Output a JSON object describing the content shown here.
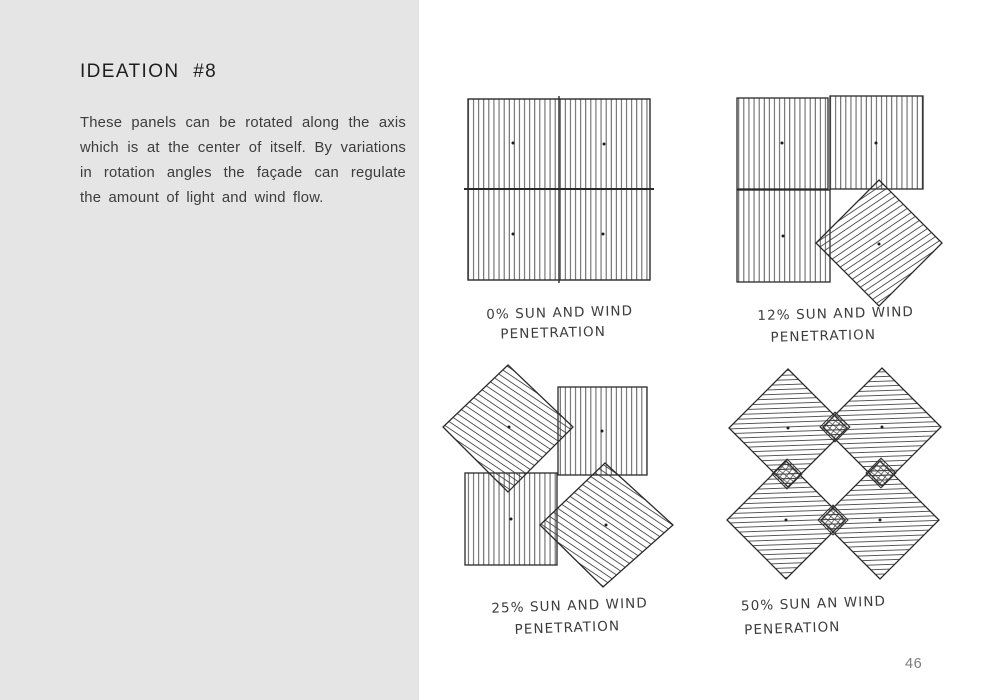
{
  "page": {
    "number": "46"
  },
  "left_panel": {
    "title": "IDEATION #8",
    "body": "These panels can be rotated along the axis which is at the center of itself. By variations in rotation angles the façade can regulate the amount of light and wind flow."
  },
  "sketches": [
    {
      "penetration_pct": 0,
      "caption1": "0% SUN AND WIND",
      "caption2": "PENETRATION"
    },
    {
      "penetration_pct": 12,
      "caption1": "12% SUN AND WIND",
      "caption2": "PENETRATION"
    },
    {
      "penetration_pct": 25,
      "caption1": "25% SUN AND WIND",
      "caption2": "PENETRATION"
    },
    {
      "penetration_pct": 50,
      "caption1": "50% SUN AN WIND",
      "caption2": "PENERATION"
    }
  ],
  "colors": {
    "panel_bg": "#e5e5e5",
    "ink": "#2a2a2a",
    "hatch": "#3f3f3f",
    "page_number": "#7c7c7c"
  }
}
